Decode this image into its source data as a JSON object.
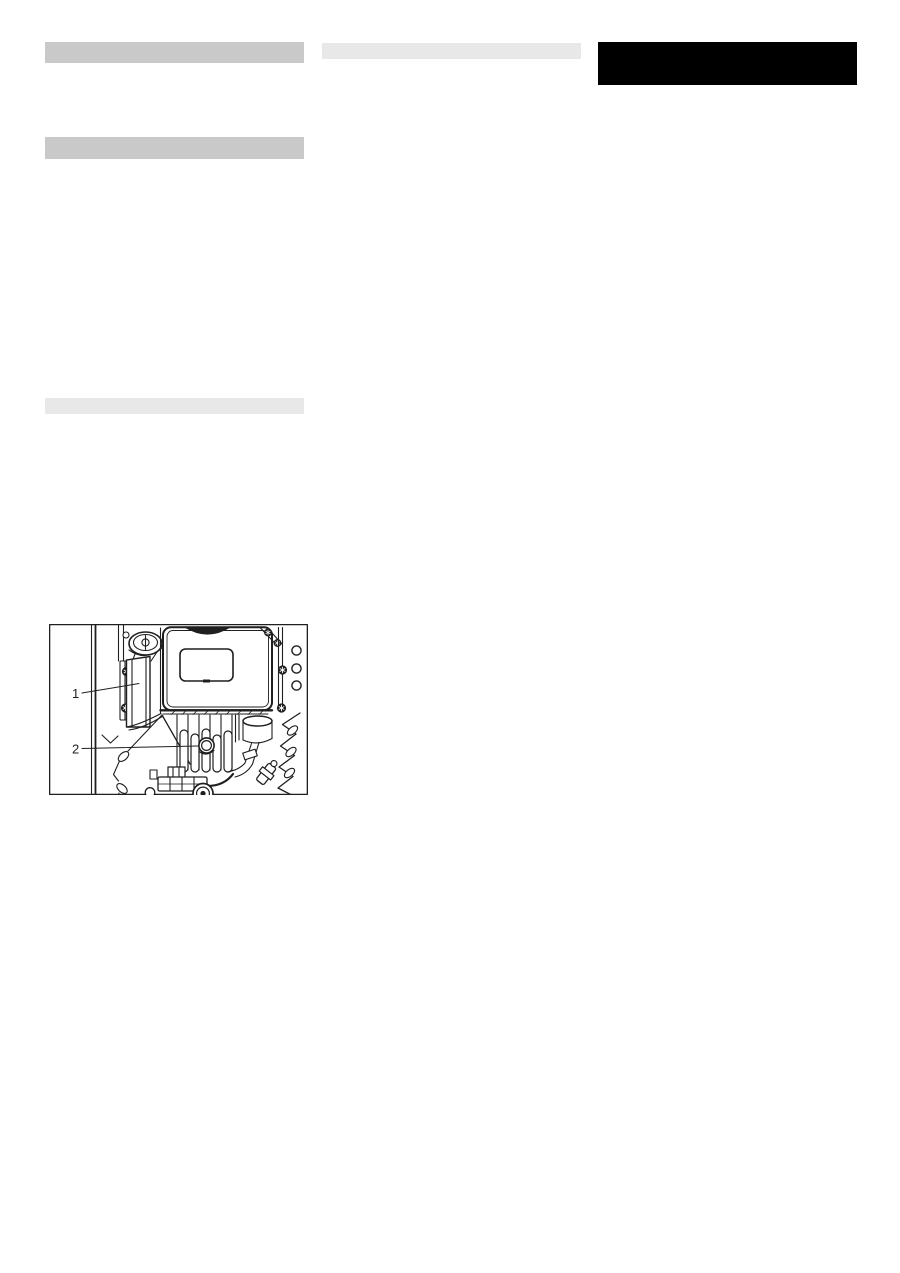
{
  "figure": {
    "callout_1": "1",
    "callout_2": "2"
  },
  "colors": {
    "page_background": "#ffffff",
    "heading_bar": "#c9c9c9",
    "subheading_bar": "#e8e8e8",
    "title_block": "#000000",
    "diagram_line": "#1f1f1f"
  }
}
